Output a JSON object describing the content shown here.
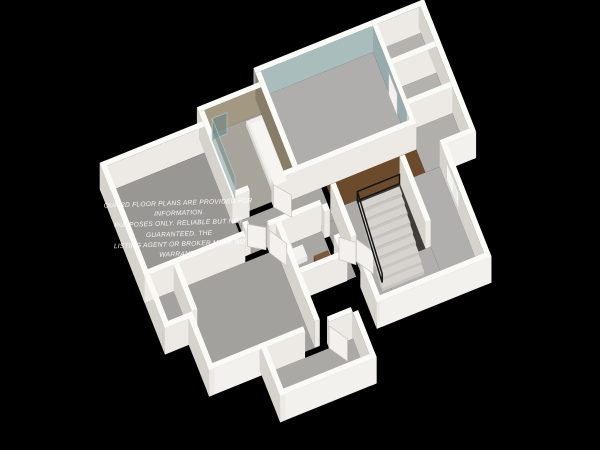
{
  "watermark": {
    "line1": "OUR 2D FLOOR PLANS ARE PROVIDED FOR INFORMATION",
    "line2": "PURPOSES ONLY. RELIABLE BUT NOT GUARANTEED. THE",
    "line3": "LISTING AGENT OR BROKER MAKE NO WARRANTY."
  },
  "scene": {
    "background": "#000000",
    "projection": {
      "origin": [
        96,
        164
      ],
      "ax": [
        9.55,
        -3.86
      ],
      "ay": [
        3.7,
        9.4
      ],
      "az": 3.3
    },
    "palette": {
      "wallTop": "#fafaf7",
      "wallW": "#d6d2cc",
      "wallS": "#edeae5",
      "wallExtS": "#f3f1ee",
      "teal": "#a9bdbd",
      "tealW": "#97abac",
      "tan": "#a39881",
      "tanW": "#877d69",
      "wood": "#6b4b2c",
      "doorWhite": "#f3f1ee",
      "glass": "rgba(116,146,146,0.5)",
      "glassEdge": "rgba(175,200,200,0.85)",
      "railing": "#161616"
    },
    "floors": [
      {
        "name": "floor-stairwell-pit",
        "rect": [
          22.25,
          13,
          26.75,
          20
        ],
        "color": "#3f3d3a"
      },
      {
        "name": "floor-nw-bedroom",
        "rect": [
          0,
          3,
          10.5,
          14
        ],
        "color": "#989794"
      },
      {
        "name": "floor-bathroom",
        "rect": [
          10.75,
          1.5,
          16.7,
          10
        ],
        "color": "#a8a49c"
      },
      {
        "name": "floor-teal-bedroom",
        "rect": [
          17.25,
          0,
          29,
          10
        ],
        "color": "#afaeac"
      },
      {
        "name": "floor-closet-a",
        "rect": [
          29.45,
          0,
          34,
          3.7
        ],
        "color": "#b3b2af"
      },
      {
        "name": "floor-closet-b",
        "rect": [
          29.45,
          4.25,
          34,
          8
        ],
        "color": "#b3b2af"
      },
      {
        "name": "floor-east-bay",
        "rect": [
          29.45,
          8.55,
          34,
          13
        ],
        "color": "#b0afac"
      },
      {
        "name": "floor-hall",
        "rect": [
          10.75,
          10.55,
          19.5,
          14
        ],
        "color": "#a7a6a3"
      },
      {
        "name": "floor-hall2",
        "rect": [
          18.55,
          14,
          19.5,
          20
        ],
        "color": "#a5a4a1"
      },
      {
        "name": "floor-landing-wood",
        "rect": [
          20.05,
          10.55,
          29.45,
          13
        ],
        "color": "wood"
      },
      {
        "name": "floor-west-closet",
        "rect": [
          0,
          14.55,
          2.5,
          19.5
        ],
        "color": "#a3a2a0"
      },
      {
        "name": "floor-sw-bedroom",
        "rect": [
          2.5,
          14.55,
          13.2,
          25
        ],
        "color": "#a2a19e"
      },
      {
        "name": "floor-small-bath",
        "rect": [
          13.75,
          14.55,
          18,
          19.5
        ],
        "color": "#a8a7a4"
      },
      {
        "name": "floor-hall3",
        "rect": [
          20.05,
          13,
          22.25,
          25
        ],
        "color": "#acaba8"
      },
      {
        "name": "floor-se-room-east",
        "rect": [
          27.3,
          13,
          30.95,
          25
        ],
        "color": "#b0afad"
      },
      {
        "name": "floor-se-room-south",
        "rect": [
          22.25,
          20,
          27.3,
          25
        ],
        "color": "#b0afad"
      },
      {
        "name": "floor-entry",
        "rect": [
          8,
          25.55,
          17,
          30
        ],
        "color": "#aaa9a6"
      }
    ],
    "walls": [
      {
        "name": "wall-n-teal",
        "rect": [
          16.7,
          -0.55,
          29,
          0
        ],
        "c": {
          "s": "teal",
          "w": "tealW"
        }
      },
      {
        "name": "wall-n-closet",
        "rect": [
          29,
          -0.55,
          34.55,
          0
        ]
      },
      {
        "name": "wall-n-bath",
        "rect": [
          10.2,
          0.95,
          16.7,
          1.5
        ],
        "c": {
          "s": "tan"
        }
      },
      {
        "name": "wall-n-nw-bedroom",
        "rect": [
          -0.55,
          2.45,
          10.2,
          3
        ]
      },
      {
        "name": "wall-w-exterior",
        "rect": [
          -0.55,
          2.45,
          0,
          19.5
        ]
      },
      {
        "name": "wall-west-closet-south",
        "rect": [
          -0.55,
          19.5,
          2.5,
          20.05
        ]
      },
      {
        "name": "wall-sw-west",
        "rect": [
          1.95,
          19.95,
          2.5,
          25.55
        ]
      },
      {
        "name": "wall-bath-east",
        "rect": [
          16.7,
          0,
          17.25,
          10
        ],
        "c": {
          "w": "tanW"
        }
      },
      {
        "name": "wall-teal-east",
        "rect": [
          29,
          0,
          29.45,
          10
        ],
        "c": {
          "w": "tealW"
        }
      },
      {
        "name": "wall-closet-divider",
        "rect": [
          29.45,
          3.7,
          34,
          4.25
        ]
      },
      {
        "name": "wall-closet-south",
        "rect": [
          29.45,
          8,
          34,
          8.55
        ]
      },
      {
        "name": "wall-e-exterior",
        "rect": [
          34,
          -0.55,
          34.55,
          13
        ]
      },
      {
        "name": "wall-bay-south",
        "rect": [
          30.95,
          13,
          34.55,
          13.55
        ],
        "c": {
          "s": "wallExtS"
        }
      },
      {
        "name": "wall-se-east",
        "rect": [
          30.95,
          13.55,
          31.5,
          25.55
        ]
      },
      {
        "name": "wall-se-south",
        "rect": [
          19.5,
          25,
          31.5,
          25.55
        ],
        "c": {
          "s": "wallExtS"
        }
      },
      {
        "name": "wall-sw-south",
        "rect": [
          1.95,
          25,
          8,
          25.55
        ],
        "c": {
          "s": "wallExtS"
        }
      },
      {
        "name": "wall-y25-a",
        "rect": [
          8,
          25,
          12,
          25.55
        ]
      },
      {
        "name": "wall-y25-b",
        "rect": [
          14.5,
          25,
          17,
          25.55
        ]
      },
      {
        "name": "wall-entry-west",
        "rect": [
          7.45,
          25,
          8,
          30.55
        ]
      },
      {
        "name": "wall-entry-south",
        "rect": [
          7.45,
          30,
          17.55,
          30.55
        ],
        "c": {
          "s": "wallExtS"
        }
      },
      {
        "name": "wall-entry-east",
        "rect": [
          17,
          25.55,
          17.55,
          30.55
        ]
      },
      {
        "name": "wall-nw-east-a",
        "rect": [
          10.2,
          1.5,
          10.75,
          10.55
        ]
      },
      {
        "name": "wall-nw-east-b",
        "rect": [
          10.2,
          13.2,
          10.75,
          14
        ]
      },
      {
        "name": "wall-hall-north-a",
        "rect": [
          10.2,
          10,
          12,
          10.55
        ]
      },
      {
        "name": "wall-hall-north-b",
        "rect": [
          14.5,
          10,
          29.45,
          10.55
        ]
      },
      {
        "name": "wall-y14-a",
        "rect": [
          -0.55,
          14,
          10,
          14.55
        ]
      },
      {
        "name": "wall-y14-b",
        "rect": [
          12.5,
          14,
          18,
          14.55
        ]
      },
      {
        "name": "wall-west-closet-east",
        "rect": [
          2.5,
          14.55,
          3.05,
          19.5
        ]
      },
      {
        "name": "wall-sw-east",
        "rect": [
          13.2,
          14.55,
          13.75,
          25
        ]
      },
      {
        "name": "wall-small-bath-east-a",
        "rect": [
          18,
          14.55,
          18.55,
          15.3
        ]
      },
      {
        "name": "wall-small-bath-east-b",
        "rect": [
          18,
          17.8,
          18.55,
          19.5
        ]
      },
      {
        "name": "wall-small-bath-south",
        "rect": [
          13.75,
          19.5,
          18.55,
          20.05
        ]
      },
      {
        "name": "wall-se-west-a",
        "rect": [
          19.5,
          13,
          20.05,
          18.6
        ]
      },
      {
        "name": "wall-se-west-b",
        "rect": [
          19.5,
          21.1,
          20.05,
          25
        ]
      },
      {
        "name": "wall-stair-east",
        "rect": [
          26.75,
          13,
          27.3,
          20
        ]
      }
    ],
    "boxes": [
      {
        "name": "bathtub",
        "rect": [
          14.9,
          2.1,
          16.7,
          9.5
        ],
        "h": 1.5,
        "top": "#efedea",
        "w": "#d8d4cf",
        "s": "#e4e1dc"
      },
      {
        "name": "toilet-tank",
        "rect": [
          14.0,
          15.3,
          14.45,
          16.8
        ],
        "h": 2.8,
        "top": "#f3f2ef",
        "w": "#dcd9d4",
        "s": "#eae7e2"
      },
      {
        "name": "toilet-bowl",
        "rect": [
          14.45,
          15.45,
          15.65,
          16.75
        ],
        "h": 1.35,
        "top": "#f3f2ef",
        "w": "#dcd9d4",
        "s": "#eae7e2"
      },
      {
        "name": "wood-vanity",
        "rect": [
          16.1,
          17.3,
          17.6,
          19.2
        ],
        "h": 2.6,
        "top": "#7a5a38",
        "w": "#563d23",
        "s": "#684a2b"
      }
    ],
    "stairs": {
      "name": "stairs",
      "x0": 22.3,
      "x1": 26.7,
      "y": 13.05,
      "count": 9,
      "dy": 0.75,
      "drop": 0.82,
      "top": "#d6d3cf",
      "w": "#bfbbb6",
      "s": "#c9c5c0"
    },
    "quads": [
      {
        "name": "shower-glass-side",
        "pts": [
          [
            11.35,
            2.1,
            0
          ],
          [
            11.35,
            8.3,
            0
          ],
          [
            11.35,
            8.3,
            6.5
          ],
          [
            11.35,
            2.1,
            6.5
          ]
        ],
        "fill": "glass",
        "stroke": "rgba(175,200,200,0.85)",
        "width": 0.8
      },
      {
        "name": "shower-glass-return",
        "pts": [
          [
            11.35,
            2.1,
            0
          ],
          [
            12.9,
            2.1,
            0
          ],
          [
            12.9,
            2.1,
            6.5
          ],
          [
            11.35,
            2.1,
            6.5
          ]
        ],
        "fill": "rgba(104,134,134,0.55)",
        "stroke": "rgba(175,200,200,0.85)",
        "width": 0.8
      },
      {
        "name": "bathtub-basin",
        "pts": [
          [
            15.15,
            2.5,
            1.52
          ],
          [
            16.45,
            2.5,
            1.52
          ],
          [
            16.45,
            9.1,
            1.52
          ],
          [
            15.15,
            9.1,
            1.52
          ]
        ],
        "fill": "#f6f5f2"
      },
      {
        "name": "door-teal-bedroom",
        "pts": [
          [
            28.9,
            4.5,
            0.05
          ],
          [
            28.9,
            6.8,
            0.05
          ],
          [
            28.9,
            6.8,
            6.9
          ],
          [
            28.9,
            4.5,
            6.9
          ]
        ],
        "fill": "#f4f2ef",
        "stroke": "#b8b4ae",
        "width": 0.7
      },
      {
        "name": "window-se-frame",
        "pts": [
          [
            30.9,
            15.1,
            2.2
          ],
          [
            30.9,
            18.15,
            2.2
          ],
          [
            30.9,
            18.15,
            6.75
          ],
          [
            30.9,
            15.1,
            6.75
          ]
        ],
        "fill": "#f6f5f3"
      },
      {
        "name": "window-se-pane-a",
        "pts": [
          [
            30.88,
            15.4,
            2.5
          ],
          [
            30.88,
            16.55,
            2.5
          ],
          [
            30.88,
            16.55,
            6.45
          ],
          [
            30.88,
            15.4,
            6.45
          ]
        ],
        "fill": "#dfe6e7"
      },
      {
        "name": "window-se-pane-b",
        "pts": [
          [
            30.88,
            16.75,
            2.5
          ],
          [
            30.88,
            17.9,
            2.5
          ],
          [
            30.88,
            17.9,
            6.45
          ],
          [
            30.88,
            16.75,
            6.45
          ]
        ],
        "fill": "#e6ecec"
      },
      {
        "name": "door-bathroom",
        "pts": [
          [
            14.5,
            10.55,
            0.05
          ],
          [
            15.75,
            12.15,
            0.05
          ],
          [
            15.75,
            12.15,
            6.8
          ],
          [
            14.5,
            10.55,
            6.8
          ]
        ],
        "fill": "doorWhite",
        "stroke": "#c6c2bc",
        "width": 0.7
      },
      {
        "name": "door-nw-bedroom",
        "pts": [
          [
            10.75,
            13.2,
            0.05
          ],
          [
            12.3,
            14.2,
            0.05
          ],
          [
            12.3,
            14.2,
            6.8
          ],
          [
            10.75,
            13.2,
            6.8
          ]
        ],
        "fill": "doorWhite",
        "stroke": "#c6c2bc",
        "width": 0.7
      },
      {
        "name": "door-small-bath",
        "pts": [
          [
            18.55,
            17.8,
            0.05
          ],
          [
            19.9,
            18.9,
            0.05
          ],
          [
            19.9,
            18.9,
            6.8
          ],
          [
            18.55,
            17.8,
            6.8
          ]
        ],
        "fill": "doorWhite",
        "stroke": "#c6c2bc",
        "width": 0.7
      },
      {
        "name": "door-sw-bedroom",
        "pts": [
          [
            12.5,
            14.55,
            0.05
          ],
          [
            13.6,
            16.45,
            0.05
          ],
          [
            13.6,
            16.45,
            6.8
          ],
          [
            12.5,
            14.55,
            6.8
          ]
        ],
        "fill": "doorWhite",
        "stroke": "#c6c2bc",
        "width": 0.7
      },
      {
        "name": "door-se-room",
        "pts": [
          [
            20.05,
            18.6,
            0.05
          ],
          [
            21.15,
            20.4,
            0.05
          ],
          [
            21.15,
            20.4,
            6.8
          ],
          [
            20.05,
            18.6,
            6.8
          ]
        ],
        "fill": "doorWhite",
        "stroke": "#c6c2bc",
        "width": 0.7
      },
      {
        "name": "door-entry",
        "pts": [
          [
            14.5,
            25.55,
            0.05
          ],
          [
            15.7,
            27.45,
            0.05
          ],
          [
            15.7,
            27.45,
            6.8
          ],
          [
            14.5,
            25.55,
            6.8
          ]
        ],
        "fill": "doorWhite",
        "stroke": "#c6c2bc",
        "width": 0.7
      }
    ],
    "strokes": [
      {
        "name": "railing-landing-guard",
        "pts": [
          [
            22.3,
            13.1,
            0.1
          ],
          [
            26.7,
            13.1,
            0.1
          ],
          [
            26.7,
            13.1,
            2.9
          ],
          [
            22.3,
            13.1,
            2.9
          ]
        ],
        "color": "railing",
        "width": 1.5
      },
      {
        "name": "railing-stair-guard",
        "pts": [
          [
            22.3,
            13.1,
            2.9
          ],
          [
            22.3,
            19.8,
            -3.0
          ],
          [
            22.3,
            19.8,
            -5.6
          ],
          [
            22.3,
            13.1,
            0.1
          ]
        ],
        "color": "railing",
        "width": 1.5
      }
    ]
  }
}
